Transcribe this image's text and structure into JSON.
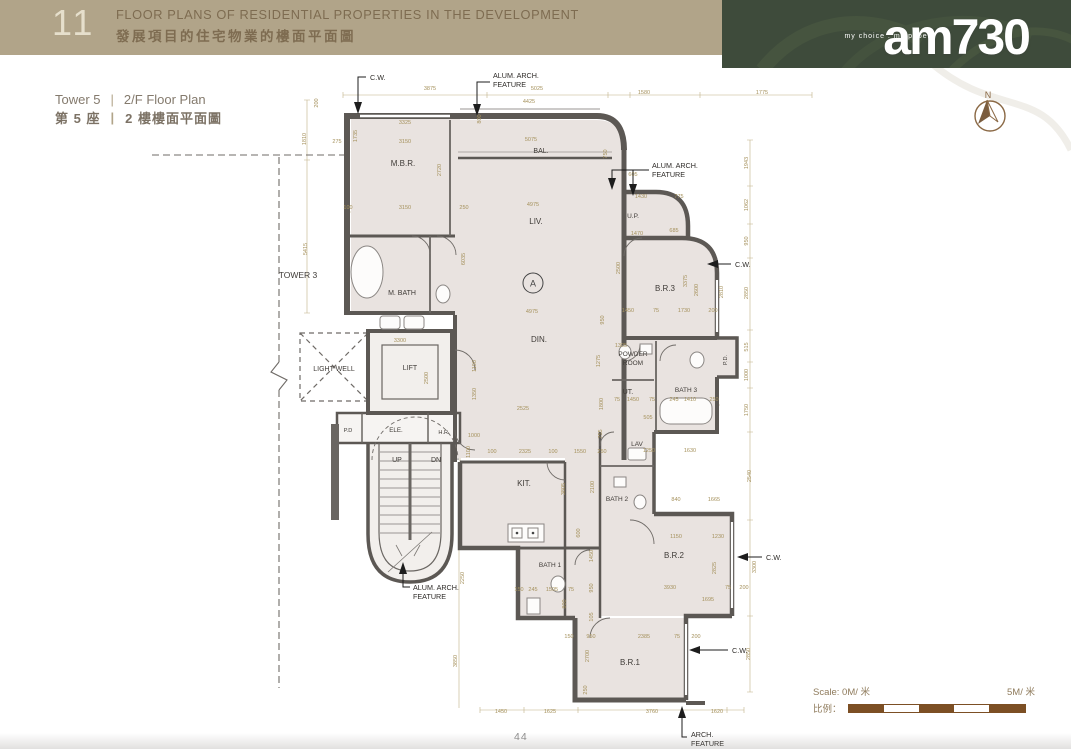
{
  "header": {
    "section_number": "11",
    "title_en": "FLOOR PLANS OF RESIDENTIAL PROPERTIES IN THE DEVELOPMENT",
    "title_zh": "發展項目的住宅物業的樓面平面圖"
  },
  "subheader": {
    "tower_en": "Tower 5",
    "plan_en": "2/F Floor Plan",
    "tower_zh": "第 5 座",
    "plan_zh": "2 樓樓面平面圖",
    "separator": "|"
  },
  "brand": {
    "tagline": "my choice . my paper",
    "logo": "am730"
  },
  "compass": {
    "label": "N"
  },
  "footer": {
    "page_number": "44",
    "scale_en": "Scale: 0M/ 米",
    "scale_end": "5M/ 米",
    "scale_zh": "比例："
  },
  "colors": {
    "header_band": "#b1a489",
    "brand_band": "#3e4b3b",
    "wall": "#5c5854",
    "room_fill": "#e9e3e0",
    "dimension_text": "#a5915c",
    "scale_bar": "#7c4f24"
  },
  "plan": {
    "unit_label": "A",
    "rooms": [
      {
        "label": "M.B.R.",
        "x": 403,
        "y": 166,
        "fs": 8
      },
      {
        "label": "BAL.",
        "x": 541,
        "y": 153,
        "fs": 7
      },
      {
        "label": "LIV.",
        "x": 536,
        "y": 224,
        "fs": 8
      },
      {
        "label": "U.P.",
        "x": 633,
        "y": 218,
        "fs": 6.5
      },
      {
        "label": "B.R.3",
        "x": 665,
        "y": 291,
        "fs": 8
      },
      {
        "label": "M. BATH",
        "x": 402,
        "y": 295,
        "fs": 7
      },
      {
        "label": "DIN.",
        "x": 539,
        "y": 342,
        "fs": 8
      },
      {
        "lines": [
          "POWDER",
          "ROOM"
        ],
        "x": 633,
        "y": 356,
        "fs": 6.5
      },
      {
        "label": "UT.",
        "x": 628,
        "y": 394,
        "fs": 7
      },
      {
        "label": "BATH 3",
        "x": 686,
        "y": 392,
        "fs": 6.5
      },
      {
        "label": "LAV",
        "x": 637,
        "y": 446,
        "fs": 6.5
      },
      {
        "label": "BATH 2",
        "x": 617,
        "y": 501,
        "fs": 6.5
      },
      {
        "label": "B.R.2",
        "x": 674,
        "y": 558,
        "fs": 8
      },
      {
        "label": "KIT.",
        "x": 524,
        "y": 486,
        "fs": 8
      },
      {
        "label": "BATH 1",
        "x": 550,
        "y": 567,
        "fs": 6.5
      },
      {
        "label": "B.R.1",
        "x": 630,
        "y": 665,
        "fs": 8
      },
      {
        "label": "LIFT",
        "x": 410,
        "y": 370,
        "fs": 7
      },
      {
        "label": "ELE.",
        "x": 396,
        "y": 432,
        "fs": 6.2
      },
      {
        "label": "P.D",
        "x": 348,
        "y": 432,
        "fs": 5.6
      },
      {
        "label": "H.R.",
        "x": 444,
        "y": 434,
        "fs": 5.6
      },
      {
        "label": "P.D.",
        "x": 727,
        "y": 360,
        "fs": 5.6,
        "v": 1
      },
      {
        "label": "UP",
        "x": 397,
        "y": 462,
        "fs": 7
      },
      {
        "label": "DN",
        "x": 436,
        "y": 462,
        "fs": 7
      },
      {
        "label": "TOWER 3",
        "x": 298,
        "y": 278,
        "fs": 8.5
      },
      {
        "label": "LIGHT WELL",
        "x": 334,
        "y": 371,
        "fs": 7
      }
    ],
    "annotations": [
      {
        "lines": [
          "C.W."
        ],
        "x": 370,
        "y": 80
      },
      {
        "lines": [
          "ALUM. ARCH.",
          "FEATURE"
        ],
        "x": 493,
        "y": 78
      },
      {
        "lines": [
          "ALUM. ARCH.",
          "FEATURE"
        ],
        "x": 652,
        "y": 168
      },
      {
        "lines": [
          "C.W."
        ],
        "x": 735,
        "y": 267
      },
      {
        "lines": [
          "C.W."
        ],
        "x": 766,
        "y": 560
      },
      {
        "lines": [
          "C.W."
        ],
        "x": 732,
        "y": 653
      },
      {
        "lines": [
          "ALUM. ARCH.",
          "FEATURE"
        ],
        "x": 413,
        "y": 590
      },
      {
        "lines": [
          "ARCH.",
          "FEATURE"
        ],
        "x": 691,
        "y": 737
      }
    ],
    "dimensions": [
      {
        "t": "3875",
        "x": 430,
        "y": 90
      },
      {
        "t": "5025",
        "x": 537,
        "y": 90
      },
      {
        "t": "4425",
        "x": 529,
        "y": 103
      },
      {
        "t": "1580",
        "x": 644,
        "y": 94
      },
      {
        "t": "1775",
        "x": 762,
        "y": 94
      },
      {
        "t": "3325",
        "x": 405,
        "y": 124
      },
      {
        "t": "3150",
        "x": 405,
        "y": 143
      },
      {
        "t": "275",
        "x": 337,
        "y": 143
      },
      {
        "t": "1735",
        "x": 357,
        "y": 136,
        "v": 1
      },
      {
        "t": "1810",
        "x": 306,
        "y": 139,
        "v": 1
      },
      {
        "t": "200",
        "x": 318,
        "y": 103,
        "v": 1
      },
      {
        "t": "800",
        "x": 481,
        "y": 119,
        "v": 1
      },
      {
        "t": "5075",
        "x": 531,
        "y": 141
      },
      {
        "t": "750",
        "x": 607,
        "y": 154,
        "v": 1
      },
      {
        "t": "2720",
        "x": 441,
        "y": 170,
        "v": 1
      },
      {
        "t": "100",
        "x": 348,
        "y": 209
      },
      {
        "t": "3150",
        "x": 405,
        "y": 209
      },
      {
        "t": "250",
        "x": 464,
        "y": 209
      },
      {
        "t": "4975",
        "x": 533,
        "y": 206
      },
      {
        "t": "6035",
        "x": 465,
        "y": 259,
        "v": 1
      },
      {
        "t": "5415",
        "x": 307,
        "y": 249,
        "v": 1
      },
      {
        "t": "605",
        "x": 633,
        "y": 176
      },
      {
        "t": "1430",
        "x": 641,
        "y": 198
      },
      {
        "t": "775",
        "x": 679,
        "y": 198
      },
      {
        "t": "1470",
        "x": 637,
        "y": 235
      },
      {
        "t": "685",
        "x": 674,
        "y": 232
      },
      {
        "t": "2500",
        "x": 620,
        "y": 268,
        "v": 1
      },
      {
        "t": "1943",
        "x": 748,
        "y": 163,
        "v": 1
      },
      {
        "t": "1062",
        "x": 748,
        "y": 205,
        "v": 1
      },
      {
        "t": "950",
        "x": 748,
        "y": 241,
        "v": 1
      },
      {
        "t": "2850",
        "x": 748,
        "y": 293,
        "v": 1
      },
      {
        "t": "515",
        "x": 748,
        "y": 347,
        "v": 1
      },
      {
        "t": "1000",
        "x": 748,
        "y": 375,
        "v": 1
      },
      {
        "t": "1750",
        "x": 748,
        "y": 410,
        "v": 1
      },
      {
        "t": "2540",
        "x": 751,
        "y": 476,
        "v": 1
      },
      {
        "t": "3300",
        "x": 756,
        "y": 567,
        "v": 1
      },
      {
        "t": "2850",
        "x": 750,
        "y": 654,
        "v": 1
      },
      {
        "t": "1450",
        "x": 628,
        "y": 312
      },
      {
        "t": "75",
        "x": 656,
        "y": 312
      },
      {
        "t": "1730",
        "x": 684,
        "y": 312
      },
      {
        "t": "200",
        "x": 713,
        "y": 312
      },
      {
        "t": "3375",
        "x": 687,
        "y": 281,
        "v": 1
      },
      {
        "t": "2600",
        "x": 698,
        "y": 290,
        "v": 1
      },
      {
        "t": "2810",
        "x": 723,
        "y": 292,
        "v": 1
      },
      {
        "t": "4975",
        "x": 532,
        "y": 313
      },
      {
        "t": "950",
        "x": 604,
        "y": 320,
        "v": 1
      },
      {
        "t": "1275",
        "x": 600,
        "y": 361,
        "v": 1
      },
      {
        "t": "1800",
        "x": 603,
        "y": 404,
        "v": 1
      },
      {
        "t": "755",
        "x": 602,
        "y": 434,
        "v": 1
      },
      {
        "t": "3300",
        "x": 400,
        "y": 342
      },
      {
        "t": "2500",
        "x": 428,
        "y": 378,
        "v": 1
      },
      {
        "t": "1100",
        "x": 476,
        "y": 366,
        "v": 1
      },
      {
        "t": "1350",
        "x": 476,
        "y": 394,
        "v": 1
      },
      {
        "t": "2525",
        "x": 523,
        "y": 410
      },
      {
        "t": "75",
        "x": 617,
        "y": 401
      },
      {
        "t": "1450",
        "x": 633,
        "y": 401
      },
      {
        "t": "75",
        "x": 652,
        "y": 401
      },
      {
        "t": "245",
        "x": 674,
        "y": 401
      },
      {
        "t": "1410",
        "x": 690,
        "y": 401
      },
      {
        "t": "250",
        "x": 714,
        "y": 401
      },
      {
        "t": "505",
        "x": 648,
        "y": 419
      },
      {
        "t": "1305",
        "x": 621,
        "y": 347
      },
      {
        "t": "100",
        "x": 492,
        "y": 453
      },
      {
        "t": "2325",
        "x": 525,
        "y": 453
      },
      {
        "t": "100",
        "x": 553,
        "y": 453
      },
      {
        "t": "1550",
        "x": 580,
        "y": 453
      },
      {
        "t": "250",
        "x": 602,
        "y": 453
      },
      {
        "t": "1250",
        "x": 649,
        "y": 452
      },
      {
        "t": "1630",
        "x": 690,
        "y": 452
      },
      {
        "t": "2100",
        "x": 594,
        "y": 487,
        "v": 1
      },
      {
        "t": "840",
        "x": 676,
        "y": 501
      },
      {
        "t": "1665",
        "x": 714,
        "y": 501
      },
      {
        "t": "1150",
        "x": 676,
        "y": 538
      },
      {
        "t": "1230",
        "x": 718,
        "y": 538
      },
      {
        "t": "2825",
        "x": 716,
        "y": 568,
        "v": 1
      },
      {
        "t": "3930",
        "x": 670,
        "y": 589
      },
      {
        "t": "75",
        "x": 728,
        "y": 589
      },
      {
        "t": "200",
        "x": 744,
        "y": 589
      },
      {
        "t": "1695",
        "x": 708,
        "y": 601
      },
      {
        "t": "3805",
        "x": 565,
        "y": 489,
        "v": 1
      },
      {
        "t": "600",
        "x": 580,
        "y": 533,
        "v": 1
      },
      {
        "t": "2250",
        "x": 464,
        "y": 578,
        "v": 1
      },
      {
        "t": "3850",
        "x": 457,
        "y": 661,
        "v": 1
      },
      {
        "t": "150",
        "x": 519,
        "y": 591
      },
      {
        "t": "245",
        "x": 533,
        "y": 591
      },
      {
        "t": "1505",
        "x": 552,
        "y": 591
      },
      {
        "t": "75",
        "x": 571,
        "y": 591
      },
      {
        "t": "800",
        "x": 566,
        "y": 604,
        "v": 1
      },
      {
        "t": "1450",
        "x": 593,
        "y": 556,
        "v": 1
      },
      {
        "t": "950",
        "x": 593,
        "y": 588,
        "v": 1
      },
      {
        "t": "105",
        "x": 593,
        "y": 617,
        "v": 1
      },
      {
        "t": "150",
        "x": 569,
        "y": 638
      },
      {
        "t": "950",
        "x": 591,
        "y": 638
      },
      {
        "t": "2385",
        "x": 644,
        "y": 638
      },
      {
        "t": "75",
        "x": 677,
        "y": 638
      },
      {
        "t": "200",
        "x": 696,
        "y": 638
      },
      {
        "t": "2700",
        "x": 589,
        "y": 656,
        "v": 1
      },
      {
        "t": "250",
        "x": 587,
        "y": 690,
        "v": 1
      },
      {
        "t": "1450",
        "x": 501,
        "y": 713
      },
      {
        "t": "1625",
        "x": 550,
        "y": 713
      },
      {
        "t": "3760",
        "x": 652,
        "y": 713
      },
      {
        "t": "1620",
        "x": 717,
        "y": 713
      },
      {
        "t": "1000",
        "x": 474,
        "y": 437
      },
      {
        "t": "1100",
        "x": 470,
        "y": 452,
        "v": 1
      }
    ]
  }
}
